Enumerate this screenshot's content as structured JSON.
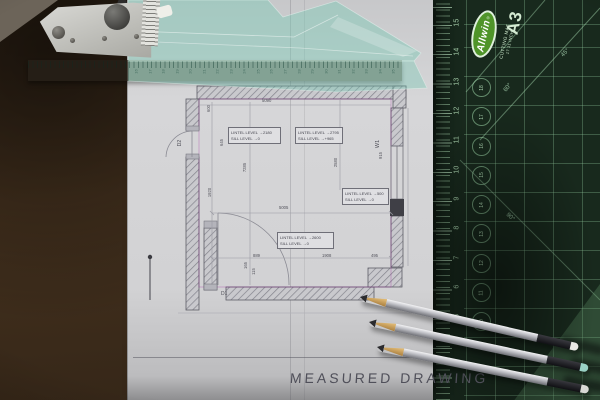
{
  "colors": {
    "desk": "#44311e",
    "paper": "#d6d6d8",
    "mat_surface": "#18291d",
    "mat_grid": "#91c89b",
    "mat_logo_green": "#4f9429",
    "set_square_tint": "#79C9B4",
    "pencil_silver": "#c9c9cd"
  },
  "ruler": {
    "numbers": [
      "16",
      "17",
      "18",
      "19",
      "20",
      "21",
      "22",
      "23",
      "24",
      "25",
      "26",
      "27",
      "28",
      "29",
      "30",
      "31",
      "32",
      "33",
      "34",
      "35"
    ]
  },
  "mat": {
    "brand": "Allwin",
    "registered": "®",
    "label_line1": "CUTTING MAT",
    "label_line2": "17 11 INCH",
    "size": "A3",
    "edge_numbers": [
      "15",
      "14",
      "13",
      "12",
      "11",
      "10",
      "9",
      "8",
      "7",
      "6",
      "5"
    ],
    "circle_numbers": [
      "18",
      "17",
      "16",
      "15",
      "14",
      "13",
      "12",
      "11",
      "10"
    ],
    "angles": {
      "a45": "45°",
      "a60": "60°",
      "a90": "90°"
    }
  },
  "plan": {
    "boxes": [
      {
        "line1": "LINTEL LEVEL →2180",
        "line2": "SILL LEVEL →0"
      },
      {
        "line1": "LINTEL LEVEL →2795",
        "line2": "SILL LEVEL →+965"
      },
      {
        "line1": "LINTEL LEVEL →500",
        "line2": "SILL LEVEL →0"
      },
      {
        "line1": "LINTEL LEVEL →2600",
        "line2": "SILL LEVEL →0"
      }
    ],
    "labels": {
      "d1": "D1",
      "d2": "D2",
      "w1": "W1"
    },
    "dims": {
      "top_width": "5090",
      "interior_width": "5005",
      "left_upper": "600",
      "left_mid": "645",
      "interior_height": "7285",
      "left_lower": "1920",
      "right_v": "2580",
      "window": "915",
      "bottom_1": "889",
      "bottom_2": "1908",
      "bottom_3": "495",
      "door_a": "165",
      "door_b": "115"
    },
    "title": "MEASURED DRAWING"
  }
}
